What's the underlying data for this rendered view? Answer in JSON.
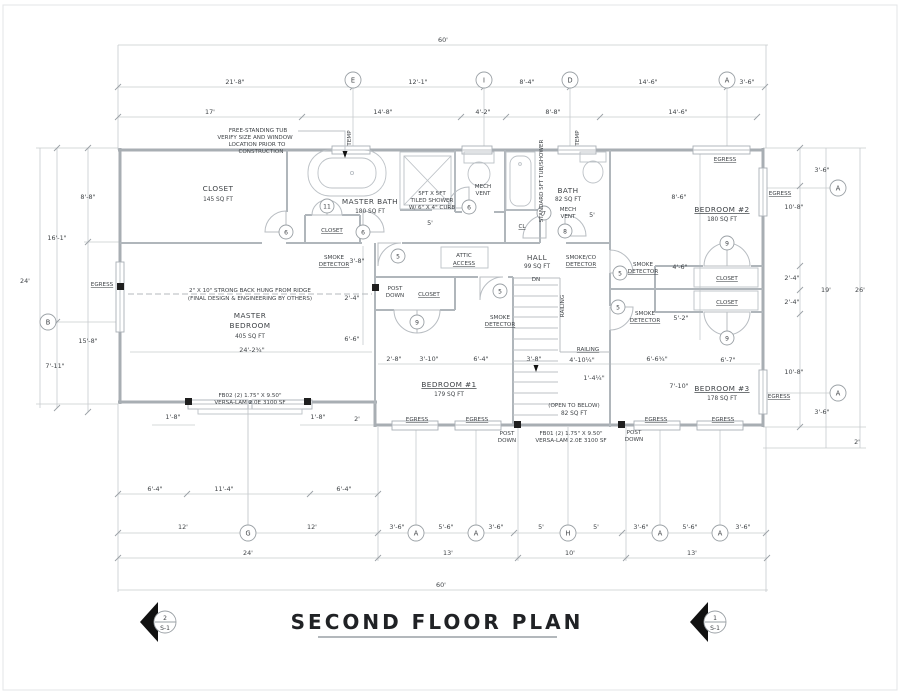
{
  "title": "SECOND FLOOR PLAN",
  "sections": {
    "left": {
      "number": "2",
      "sheet": "S-1"
    },
    "right": {
      "number": "1",
      "sheet": "S-1"
    }
  },
  "grid": {
    "A": "A",
    "B": "B",
    "D": "D",
    "E": "E",
    "G": "G",
    "H": "H",
    "I": "I"
  },
  "doors": {
    "n5": "5",
    "n6": "6",
    "n7": "7",
    "n8": "8",
    "n9": "9",
    "n11": "11"
  },
  "rooms": {
    "master_closet": {
      "name": "CLOSET",
      "area": "145 SQ FT"
    },
    "master_bath": {
      "name": "MASTER BATH",
      "area": "180 SQ FT"
    },
    "bath": {
      "name": "BATH",
      "area": "82 SQ FT"
    },
    "bedroom2": {
      "name": "BEDROOM #2",
      "area": "180 SQ FT"
    },
    "master_bedroom": {
      "line1": "MASTER",
      "line2": "BEDROOM",
      "area": "405 SQ FT"
    },
    "bedroom1": {
      "name": "BEDROOM #1",
      "area": "179 SQ FT"
    },
    "bedroom3": {
      "name": "BEDROOM #3",
      "area": "178 SQ FT"
    },
    "hall": {
      "name": "HALL",
      "area": "99 SQ FT"
    },
    "open_below": {
      "name": "(OPEN TO BELOW)",
      "area": "82 SQ FT"
    },
    "closet": "CLOSET",
    "cl": "CL"
  },
  "labels": {
    "egress": "EGRESS",
    "temp": "TEMP",
    "smoke1": "SMOKE",
    "smoke2": "DETECTOR",
    "smokeco1": "SMOKE/CO",
    "smokeco2": "DETECTOR",
    "mech1": "MECH",
    "mech2": "VENT",
    "post1": "POST",
    "post2": "DOWN",
    "attic1": "ATTIC",
    "attic2": "ACCESS",
    "dn": "DN",
    "railing": "RAILING",
    "tub_shower": "STANDARD 5FT TUB/SHOWER"
  },
  "notes": {
    "tub": [
      "FREE-STANDING TUB",
      "VERIFY SIZE AND WINDOW",
      "LOCATION PRIOR TO",
      "CONSTRUCTION"
    ],
    "shower": [
      "5FT X 5FT",
      "TILED SHOWER",
      "W/ 6\" X 4\" CURB"
    ],
    "strongback": [
      "2\" X 10\" STRONG BACK HUNG FROM RIDGE",
      "(FINAL DESIGN & ENGINEERING BY OTHERS)"
    ],
    "beam_fb02": [
      "FB02 (2) 1.75\" X 9.50\"",
      "VERSA-LAM 2.0E 3100 SF"
    ],
    "beam_fb01": [
      "FB01 (2) 1.75\" X 9.50\"",
      "VERSA-LAM 2.0E 3100 SF"
    ]
  },
  "dims": {
    "ft60": "60'",
    "ft24": "24'",
    "ft26": "26'",
    "ft19": "19'",
    "ft17": "17'",
    "ft12": "12'",
    "ft13": "13'",
    "ft10": "10'",
    "ft5": "5'",
    "ft2": "2'",
    "d21_8": "21'-8\"",
    "d12_1": "12'-1\"",
    "d8_4": "8'-4\"",
    "d14_6": "14'-6\"",
    "d3_6": "3'-6\"",
    "d14_8": "14'-8\"",
    "d4_2": "4'-2\"",
    "d8_8": "8'-8\"",
    "d16_1": "16'-1\"",
    "d7_11": "7'-11\"",
    "d15_8": "15'-8\"",
    "d8_6": "8'-6\"",
    "d10_8": "10'-8\"",
    "d2_4": "2'-4\"",
    "d6_4": "6'-4\"",
    "d11_4": "11'-4\"",
    "d5_6": "5'-6\"",
    "d1_8": "1'-8\"",
    "d3_8": "3'-8\"",
    "d2_8": "2'-8\"",
    "d3_10": "3'-10\"",
    "d4_6": "4'-6\"",
    "d5_2": "5'-2\"",
    "d6_6": "6'-6\"",
    "d6_6q": "6'-6¾\"",
    "d6_7": "6'-7\"",
    "d7_10": "7'-10\"",
    "d24_2": "24'-2¾\"",
    "d4_10": "4'-10¼\"",
    "d1_4": "1'-4¼\""
  }
}
